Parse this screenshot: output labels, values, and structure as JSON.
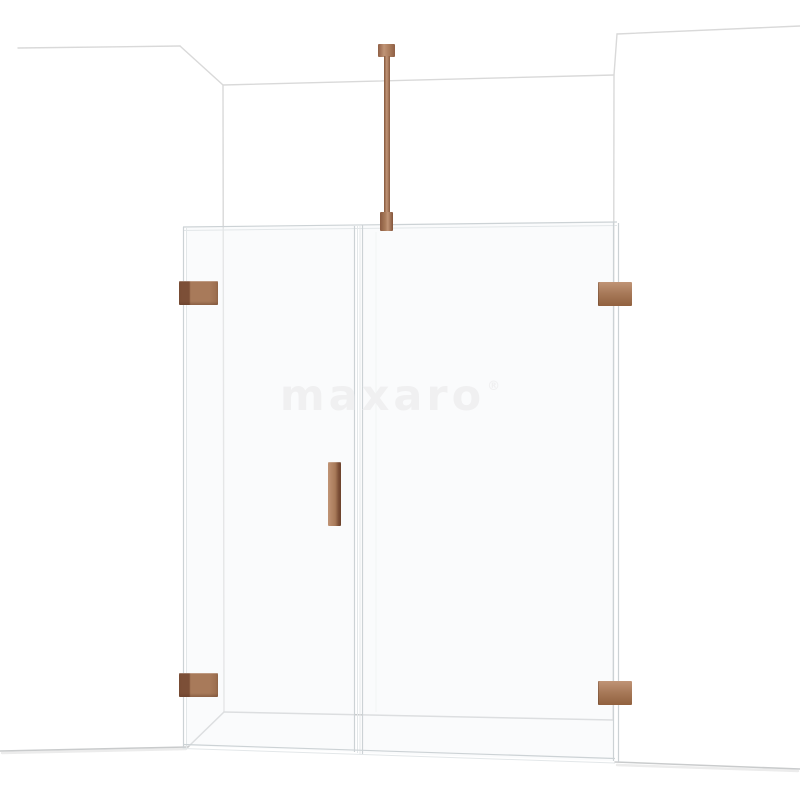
{
  "watermark": {
    "text": "maxaro",
    "mark": "®"
  },
  "colors": {
    "background": "#ffffff",
    "copper": "#a87a5a",
    "copper_dark": "#7c4f37",
    "copper_light": "#c09476",
    "wall_line": "#d9d9d9",
    "floor_line": "#c9cbcc",
    "glass_edge": "#ccd2d5",
    "glass_tint": "rgba(243,246,248,0.45)",
    "watermark_color": "#f0f0f1"
  }
}
